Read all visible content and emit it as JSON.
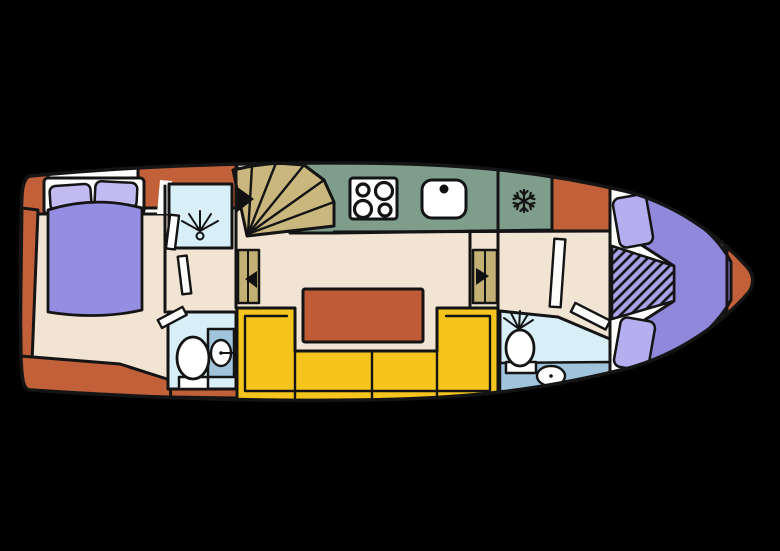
{
  "page": {
    "title": "boat-deck-floor-plan"
  },
  "colors": {
    "background": "#000000",
    "outline": "#141414",
    "hull_accent": "#c2603a",
    "floor_cream": "#f1e4d3",
    "deck_white": "#fdfdfc",
    "counter_green": "#7e9d8b",
    "stairs_khaki": "#c9b77e",
    "cabinet_khaki": "#c3b075",
    "sofa_yellow": "#f6c51d",
    "table_terracotta": "#c05b38",
    "bed_purple": "#938ee2",
    "pillow_lavender": "#c1bbf2",
    "vberth_purple": "#8f88db",
    "cushion_lavender": "#b5afef",
    "hatch_lavender": "#a8a2e6",
    "bath_light_blue": "#d8eff8",
    "bath_medium_blue": "#9fc4db",
    "fixture_white": "#ffffff",
    "icon_black": "#111111"
  },
  "rooms": {
    "aft_cabin": "aft cabin with double bed",
    "aft_shower": "shower room",
    "aft_bathroom": "aft bathroom",
    "galley": "galley with stove, sink and freezer",
    "saloon": "saloon with U-shaped sofa and table",
    "bow_bathroom": "forward bathroom",
    "bow_cabin": "bow v-berth cabin"
  },
  "fixtures": {
    "stove": "stove-icon",
    "sink": "sink-icon",
    "freezer": "snowflake-icon",
    "shower": "shower-icon",
    "toilet": "toilet-icon",
    "washbasin": "washbasin-icon",
    "stairs": "companionway-stairs",
    "wardrobe": "wardrobe-cabinet",
    "door": "door-leaf"
  }
}
